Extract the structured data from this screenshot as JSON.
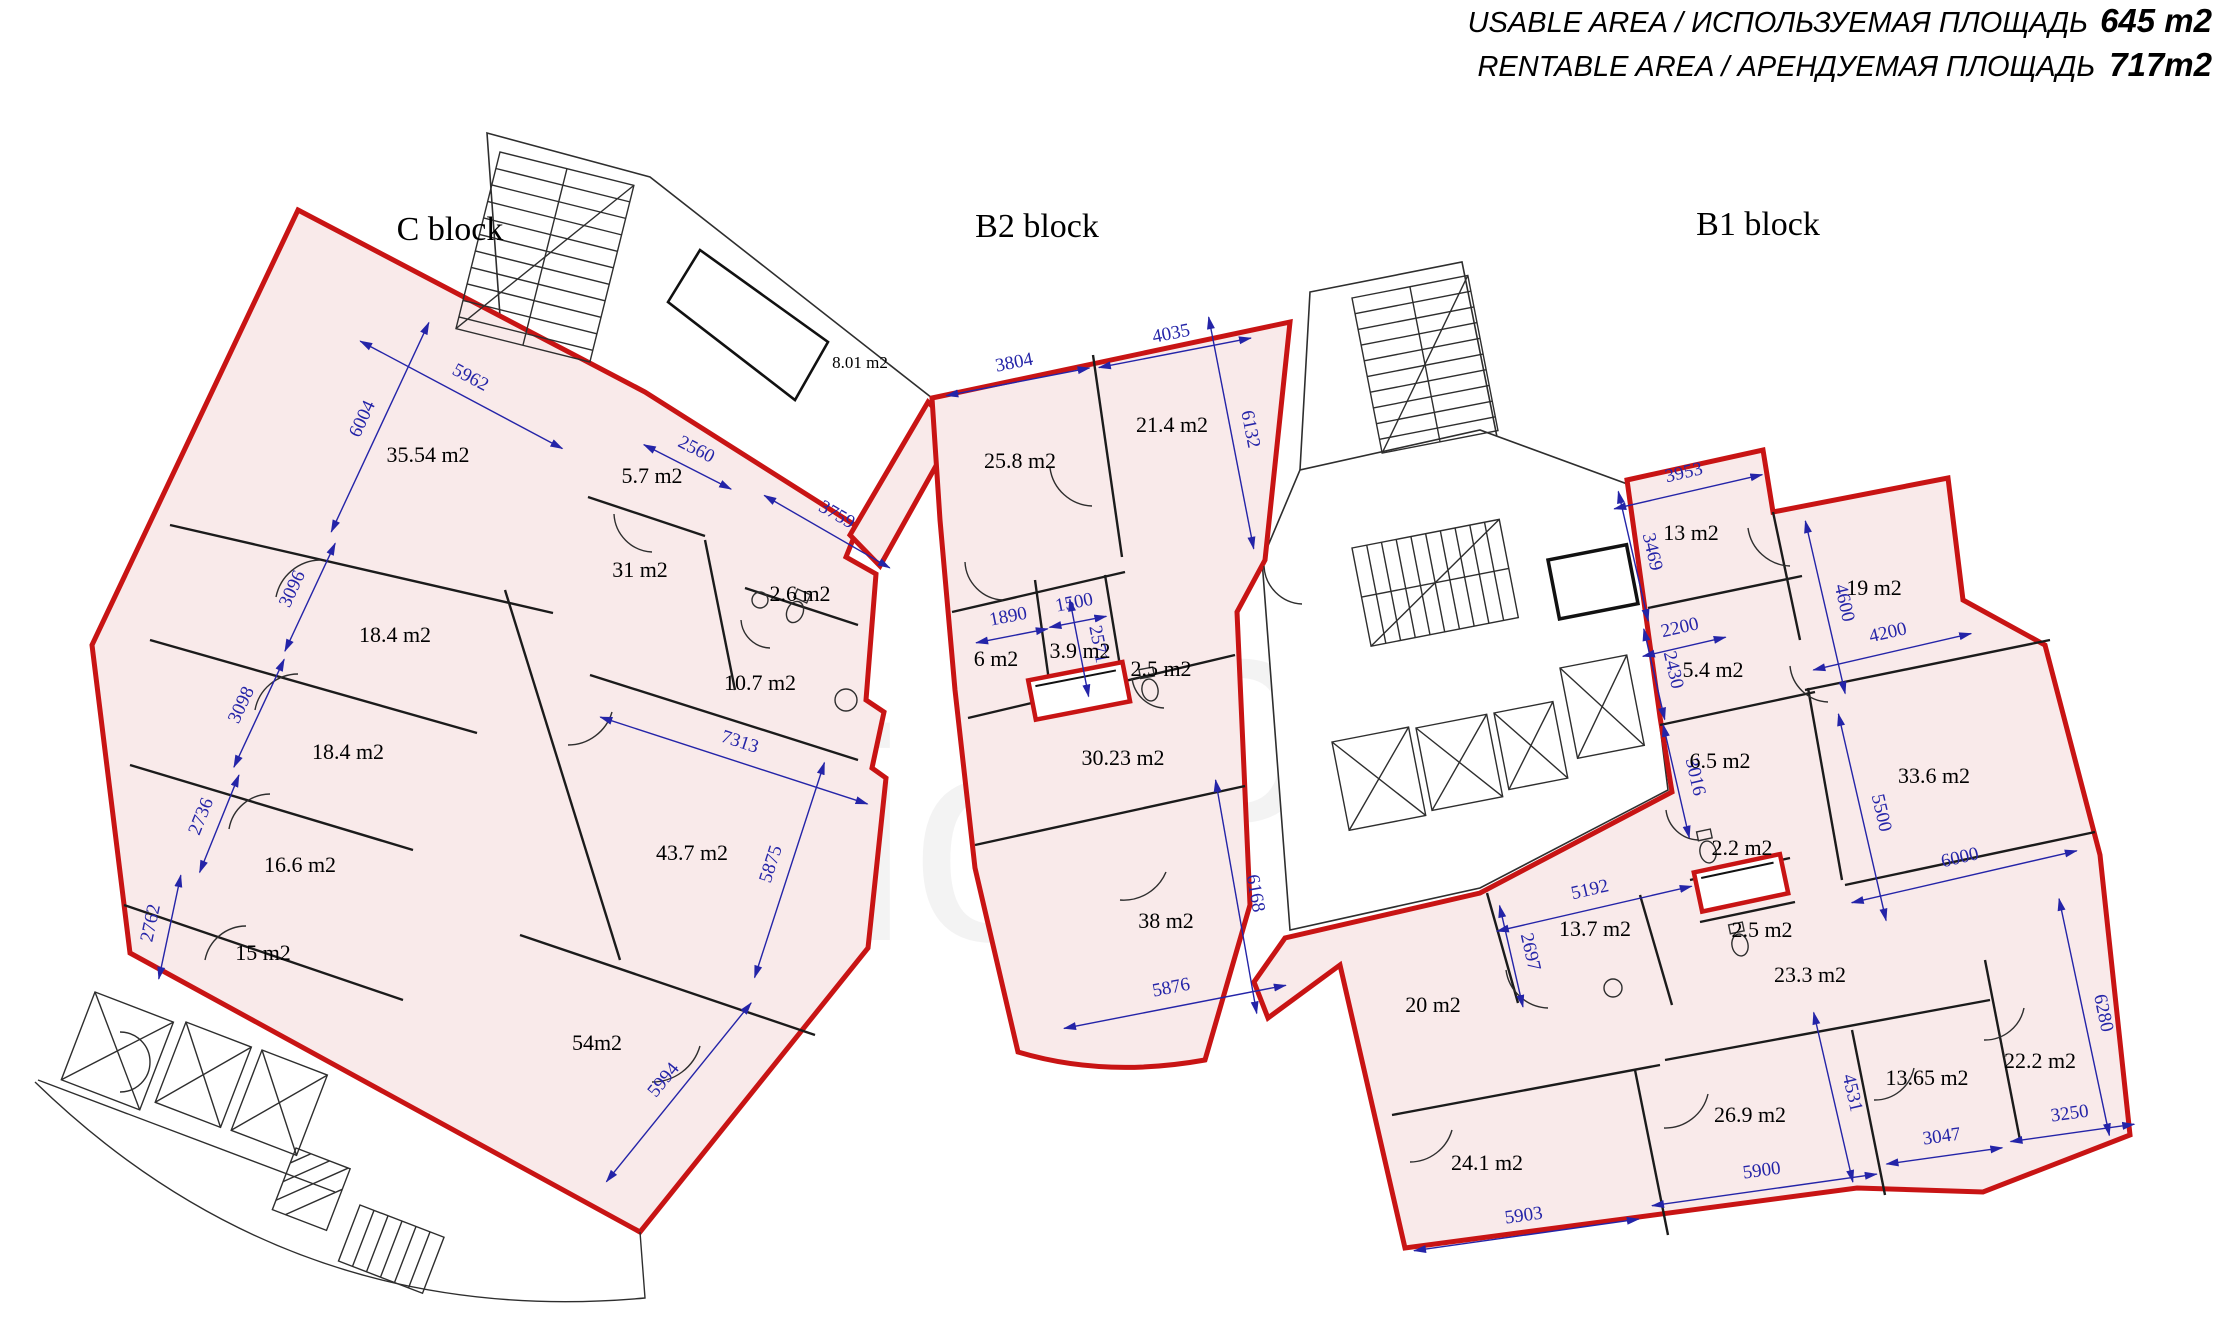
{
  "header": {
    "usable_label": "USABLE AREA / ИСПОЛЬЗУЕМАЯ ПЛОЩАДЬ",
    "usable_value": "645 m2",
    "rentable_label": "RENTABLE AREA / АРЕНДУЕМАЯ ПЛОЩАДЬ",
    "rentable_value": "717m2"
  },
  "blocks": [
    {
      "label": "C block"
    },
    {
      "label": "B2 block"
    },
    {
      "label": "B1 block"
    }
  ],
  "watermark": {
    "left": "onlio",
    "right": "oins"
  },
  "colors": {
    "pink": "#f9eaea",
    "red": "#c81414",
    "blue": "#2424a8",
    "wall": "#1b1b1b"
  },
  "rooms": [
    {
      "block": "C",
      "label": "35.54 m2",
      "x": 428,
      "y": 462
    },
    {
      "block": "C",
      "label": "5.7 m2",
      "x": 652,
      "y": 483
    },
    {
      "block": "C",
      "label": "31 m2",
      "x": 640,
      "y": 577
    },
    {
      "block": "C",
      "label": "2.6 m2",
      "x": 800,
      "y": 601
    },
    {
      "block": "C",
      "label": "10.7 m2",
      "x": 760,
      "y": 690
    },
    {
      "block": "C",
      "label": "18.4 m2",
      "x": 395,
      "y": 642
    },
    {
      "block": "C",
      "label": "18.4 m2",
      "x": 348,
      "y": 759
    },
    {
      "block": "C",
      "label": "16.6 m2",
      "x": 300,
      "y": 872
    },
    {
      "block": "C",
      "label": "15 m2",
      "x": 263,
      "y": 960
    },
    {
      "block": "C",
      "label": "43.7 m2",
      "x": 692,
      "y": 860
    },
    {
      "block": "C",
      "label": "54m2",
      "x": 597,
      "y": 1050
    },
    {
      "block": "core",
      "label": "8.01 m2",
      "x": 860,
      "y": 368,
      "small": true
    },
    {
      "block": "B2",
      "label": "25.8 m2",
      "x": 1020,
      "y": 468
    },
    {
      "block": "B2",
      "label": "21.4 m2",
      "x": 1172,
      "y": 432
    },
    {
      "block": "B2",
      "label": "6 m2",
      "x": 996,
      "y": 666
    },
    {
      "block": "B2",
      "label": "3.9 m2",
      "x": 1080,
      "y": 658
    },
    {
      "block": "B2",
      "label": "2.5 m2",
      "x": 1161,
      "y": 676
    },
    {
      "block": "B2",
      "label": "30.23 m2",
      "x": 1123,
      "y": 765
    },
    {
      "block": "B2",
      "label": "38 m2",
      "x": 1166,
      "y": 928
    },
    {
      "block": "B1",
      "label": "13 m2",
      "x": 1691,
      "y": 540
    },
    {
      "block": "B1",
      "label": "19 m2",
      "x": 1874,
      "y": 595
    },
    {
      "block": "B1",
      "label": "5.4 m2",
      "x": 1713,
      "y": 677
    },
    {
      "block": "B1",
      "label": "6.5 m2",
      "x": 1720,
      "y": 768
    },
    {
      "block": "B1",
      "label": "33.6 m2",
      "x": 1934,
      "y": 783
    },
    {
      "block": "B1",
      "label": "2.2 m2",
      "x": 1742,
      "y": 855
    },
    {
      "block": "B1",
      "label": "13.7 m2",
      "x": 1595,
      "y": 936
    },
    {
      "block": "B1",
      "label": "2.5 m2",
      "x": 1762,
      "y": 937
    },
    {
      "block": "B1",
      "label": "23.3 m2",
      "x": 1810,
      "y": 982
    },
    {
      "block": "B1",
      "label": "20 m2",
      "x": 1433,
      "y": 1012
    },
    {
      "block": "B1",
      "label": "24.1 m2",
      "x": 1487,
      "y": 1170
    },
    {
      "block": "B1",
      "label": "26.9 m2",
      "x": 1750,
      "y": 1122
    },
    {
      "block": "B1",
      "label": "13.65 m2",
      "x": 1927,
      "y": 1085
    },
    {
      "block": "B1",
      "label": "22.2 m2",
      "x": 2040,
      "y": 1068
    }
  ],
  "dims": [
    {
      "label": "5962",
      "x": 466,
      "y": 386,
      "angle": 28,
      "len": 229
    },
    {
      "label": "2560",
      "x": 692,
      "y": 458,
      "angle": 27,
      "len": 98
    },
    {
      "label": "3759",
      "x": 832,
      "y": 523,
      "angle": 30,
      "len": 145
    },
    {
      "label": "6004",
      "x": 371,
      "y": 423,
      "angle": -65,
      "len": 231
    },
    {
      "label": "3096",
      "x": 301,
      "y": 593,
      "angle": -65,
      "len": 119
    },
    {
      "label": "3098",
      "x": 250,
      "y": 709,
      "angle": -65,
      "len": 119
    },
    {
      "label": "2736",
      "x": 210,
      "y": 820,
      "angle": -68,
      "len": 105
    },
    {
      "label": "2762",
      "x": 160,
      "y": 925,
      "angle": -78,
      "len": 106
    },
    {
      "label": "7313",
      "x": 737,
      "y": 751,
      "angle": 18,
      "len": 281
    },
    {
      "label": "5875",
      "x": 780,
      "y": 867,
      "angle": -72,
      "len": 226
    },
    {
      "label": "5994",
      "x": 671,
      "y": 1086,
      "angle": -51,
      "len": 230
    },
    {
      "label": "3804",
      "x": 1016,
      "y": 372,
      "angle": -11,
      "len": 146
    },
    {
      "label": "4035",
      "x": 1173,
      "y": 343,
      "angle": -11,
      "len": 155
    },
    {
      "label": "6132",
      "x": 1241,
      "y": 431,
      "angle": 79,
      "len": 236
    },
    {
      "label": "1890",
      "x": 1010,
      "y": 626,
      "angle": -11,
      "len": 73
    },
    {
      "label": "1500",
      "x": 1076,
      "y": 612,
      "angle": -11,
      "len": 58
    },
    {
      "label": "2571",
      "x": 1089,
      "y": 646,
      "angle": 79,
      "len": 99
    },
    {
      "label": "6168",
      "x": 1246,
      "y": 895,
      "angle": 80,
      "len": 237
    },
    {
      "label": "5876",
      "x": 1173,
      "y": 997,
      "angle": -11,
      "len": 226
    },
    {
      "label": "3953",
      "x": 1686,
      "y": 482,
      "angle": -13,
      "len": 152
    },
    {
      "label": "3469",
      "x": 1643,
      "y": 554,
      "angle": 77,
      "len": 133
    },
    {
      "label": "2200",
      "x": 1682,
      "y": 637,
      "angle": -13,
      "len": 85
    },
    {
      "label": "2430",
      "x": 1664,
      "y": 672,
      "angle": 77,
      "len": 93
    },
    {
      "label": "4600",
      "x": 1835,
      "y": 605,
      "angle": 77,
      "len": 177
    },
    {
      "label": "4200",
      "x": 1890,
      "y": 642,
      "angle": -13,
      "len": 162
    },
    {
      "label": "3016",
      "x": 1686,
      "y": 779,
      "angle": 77,
      "len": 116
    },
    {
      "label": "5500",
      "x": 1872,
      "y": 815,
      "angle": 77,
      "len": 212
    },
    {
      "label": "6000",
      "x": 1962,
      "y": 867,
      "angle": -13,
      "len": 231
    },
    {
      "label": "5192",
      "x": 1592,
      "y": 899,
      "angle": -13,
      "len": 200
    },
    {
      "label": "2697",
      "x": 1521,
      "y": 954,
      "angle": 77,
      "len": 104
    },
    {
      "label": "4531",
      "x": 1843,
      "y": 1095,
      "angle": 77,
      "len": 174
    },
    {
      "label": "5903",
      "x": 1525,
      "y": 1225,
      "angle": -8,
      "len": 227
    },
    {
      "label": "5900",
      "x": 1763,
      "y": 1180,
      "angle": -8,
      "len": 227
    },
    {
      "label": "3047",
      "x": 1943,
      "y": 1146,
      "angle": -8,
      "len": 117
    },
    {
      "label": "3250",
      "x": 2071,
      "y": 1123,
      "angle": -8,
      "len": 125
    },
    {
      "label": "6280",
      "x": 2094,
      "y": 1015,
      "angle": 78,
      "len": 242
    }
  ]
}
